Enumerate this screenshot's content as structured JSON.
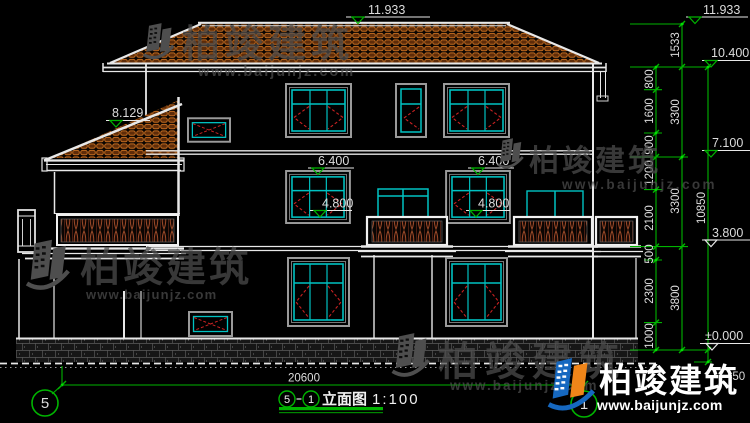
{
  "drawing": {
    "type": "elevation",
    "background": "#000000"
  },
  "levels": {
    "ridge_center": "11.933",
    "ridge_right": "11.933",
    "eave_right": "10.400",
    "porch": "8.129",
    "f3_left": "6.400",
    "f3_right": "6.400",
    "f2_left": "4.800",
    "f2_right": "4.800",
    "r_7100": "7.100",
    "r_3800": "3.800",
    "r_zero": "±0.000"
  },
  "dims": {
    "chain_a": [
      "800",
      "1600",
      "900",
      "1200",
      "2100",
      "500",
      "2300",
      "1000"
    ],
    "chain_b": [
      "1533",
      "3300",
      "3300",
      "3800"
    ],
    "total_height": "10850",
    "plinth": "450",
    "total_width": "20600"
  },
  "axes": {
    "left": "5",
    "right": "1"
  },
  "titlebar": {
    "axis_from": "5",
    "axis_to": "1",
    "name": "立面图",
    "scale": "1:100"
  },
  "watermark": {
    "cn": "柏竣建筑",
    "url": "www.baijunjz.com"
  },
  "logo": {
    "cn": "柏竣建筑",
    "url": "www.baijunjz.com"
  },
  "colors": {
    "cad_green": "#00b400",
    "cad_cyan": "#00c2c2",
    "cad_red": "#c82222",
    "tile_orange": "#c06a1f",
    "logo_blue": "#1668c0",
    "logo_orange": "#f08519"
  }
}
